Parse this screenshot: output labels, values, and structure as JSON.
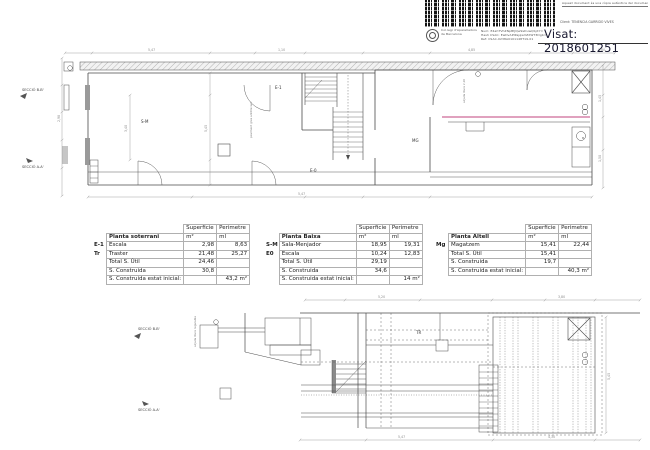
{
  "stamp": {
    "top_strip": "Aquest document és una còpia autèntica del document original",
    "client_line": "Client:      TENENCIA GARRIDO VIVES",
    "visat": "Visat: 2018601251",
    "college": "Col·legi d'Aparelladors de Barcelona",
    "hash1": "Num: E4ahTVhZNpBtJQw9sDuwQbjXY=",
    "hash2": "Hash CSAC: EwDvAPIRsjqwVZXWT3Dgb=",
    "hash3": "Ref: CSAC-0238A0101148T19-01"
  },
  "tables": [
    {
      "title": "Planta soterrani",
      "header": {
        "superficie": "Superficie",
        "perimetre": "Perimetre",
        "sup_unit": "m²",
        "per_unit": "ml"
      },
      "rows": [
        {
          "code": "E-1",
          "label": "Escala",
          "sup": "2,98",
          "per": "8,63"
        },
        {
          "code": "Tr",
          "label": "Traster",
          "sup": "21,48",
          "per": "25,27"
        },
        {
          "code": "",
          "label": "Total S. Útil",
          "sup": "24,46",
          "per": ""
        },
        {
          "code": "",
          "label": "S. Construida",
          "sup": "30,8",
          "per": ""
        },
        {
          "code": "",
          "label": "S. Construida estat inicial:",
          "sup": "",
          "per": "43,2 m²"
        }
      ]
    },
    {
      "title": "Planta Baixa",
      "header": {
        "superficie": "Superficie",
        "perimetre": "Perimetre",
        "sup_unit": "m²",
        "per_unit": "ml"
      },
      "rows": [
        {
          "code": "S-M",
          "label": "Sala-Menjador",
          "sup": "18,95",
          "per": "19,31"
        },
        {
          "code": "E0",
          "label": "Escala",
          "sup": "10,24",
          "per": "12,83"
        },
        {
          "code": "",
          "label": "Total S. Útil",
          "sup": "29,19",
          "per": ""
        },
        {
          "code": "",
          "label": "S. Construida",
          "sup": "34,6",
          "per": ""
        },
        {
          "code": "",
          "label": "S. Construida estat inicial:",
          "sup": "",
          "per": "14 m²"
        }
      ]
    },
    {
      "title": "Planta Altell",
      "header": {
        "superficie": "Superficie",
        "perimetre": "Perimetre",
        "sup_unit": "m²",
        "per_unit": "ml"
      },
      "rows": [
        {
          "code": "Mg",
          "label": "Magatzem",
          "sup": "15,41",
          "per": "22,44"
        },
        {
          "code": "",
          "label": "Total S. Útil",
          "sup": "15,41",
          "per": ""
        },
        {
          "code": "",
          "label": "S. Construida",
          "sup": "19,7",
          "per": ""
        },
        {
          "code": "",
          "label": "S. Construida estat inicial:",
          "sup": "",
          "per": "40,3 m²"
        }
      ]
    }
  ],
  "plan": {
    "rooms": {
      "sm": "S-M",
      "e1": "E-1",
      "e0": "E-0",
      "mg": "MG",
      "tr": "TR"
    },
    "sections": {
      "bb": "SECCIÓ B-B'",
      "aa": "SECCIÓ A-A'"
    },
    "annotations": {
      "a1": "paviment gres antilliscant",
      "a2": "alçada lliure 2,20",
      "a3": "alçada lliure regulable"
    }
  },
  "dims": [
    "5,47",
    "1,10",
    "4,85",
    "0,80",
    "2,98",
    "1,45",
    "1,50",
    "5,47",
    "3,40",
    "5,45",
    "5,20",
    "3,80",
    "5,45",
    "5,47",
    "4,30"
  ],
  "colors": {
    "line": "#4b4b4b",
    "service_line": "#c2437c",
    "visat_text": "#17172f"
  }
}
